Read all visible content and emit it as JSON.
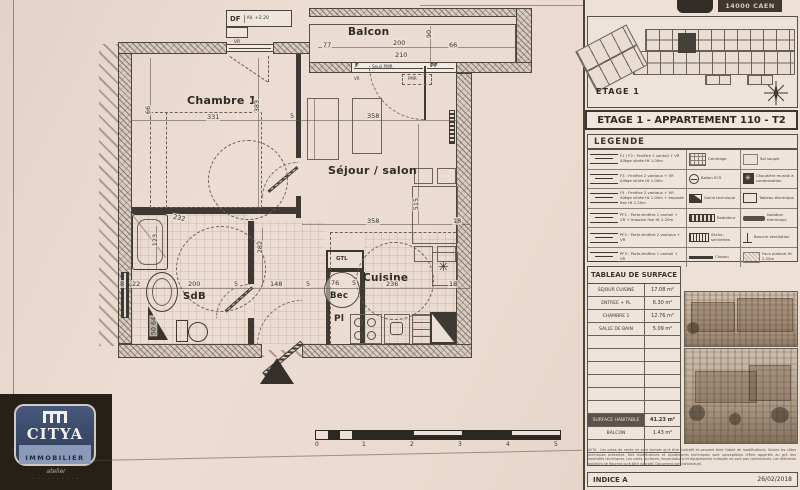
{
  "plan": {
    "rooms": {
      "chambre": "Chambre 1",
      "sejour": "Séjour / salon",
      "sdb": "SdB",
      "cuisine": "Cuisine",
      "balcon": "Balcon",
      "pl": "Pl",
      "bec": "Bec",
      "gtl": "GTL"
    },
    "annotations": {
      "df": "DF",
      "df_note": "All. +2.20",
      "vr": "VR",
      "f": "F",
      "seuil": "Seuil PMR",
      "pf": "PF",
      "vr2": "VR",
      "pmr": "PMR"
    },
    "dims": {
      "d77": "77",
      "d200": "200",
      "d210": "210",
      "d66b": "66",
      "d90": "90",
      "d331": "331",
      "d383": "383",
      "d66v": "66",
      "d5a": "5",
      "d358t": "358",
      "d358b": "358",
      "d515": "515",
      "d18a": "18",
      "d8": "8",
      "d22": "22",
      "d123": "123",
      "d200s": "200",
      "d5b": "5",
      "d148": "148",
      "d5c": "5",
      "d76": "76",
      "d5d": "5",
      "d236": "236",
      "d18b": "18",
      "d282": "282",
      "d232": "232",
      "d5064": "50 64"
    },
    "scalebar": {
      "t0": "0",
      "t1": "1",
      "t2": "2",
      "t3": "3",
      "t4": "4",
      "t5": "5"
    }
  },
  "logo": {
    "brand": "CITYA",
    "subbrand": "IMMOBILIER",
    "tagline": "atelier",
    "letters": "· · · · · · · · · ·"
  },
  "sidebar": {
    "header": {
      "city": "14000 CAEN"
    },
    "siteplan": {
      "floor": "ETAGE 1"
    },
    "title": "ETAGE 1 - APPARTEMENT 110 - T2",
    "legend": {
      "heading": "LEGENDE",
      "rows": [
        {
          "left": "F1 / F2 : Fenêtre 1 vantail + VR Allège vitrée Ht 1.00m",
          "mid": "Carrelage",
          "right": "Sol souple"
        },
        {
          "left": "F3 : Fenêtre 2 vantaux + VR Allège vitrée Ht 1.00m",
          "mid": "Ballon ECS",
          "right": "Chaudière murale à condensation"
        },
        {
          "left": "F4 : Fenêtre 2 vantaux + VR Allège vitrée Ht 1.00m + Imposte fixe Ht 2.20m",
          "mid": "Gaine technique",
          "right": "Tableau électrique"
        },
        {
          "left": "PF1 : Porte-fenêtre 1 vantail + VR + Imposte fixe Ht 2.20m",
          "mid": "Radiateur",
          "right": "Isolation thermique"
        },
        {
          "left": "PF2 : Porte-fenêtre 2 vantaux + VR",
          "mid": "Sèche-serviettes",
          "right": "Bouche ventilation"
        },
        {
          "left": "PF3 : Porte-fenêtre 1 vantail + VR",
          "mid": "Cloison",
          "right": "Faux plafond Ht 2.20m"
        }
      ]
    },
    "surface_table": {
      "heading": "TABLEAU DE SURFACE",
      "rows": [
        {
          "label": "SEJOUR CUISINE",
          "value": "17.08 m²"
        },
        {
          "label": "ENTREE + PL",
          "value": "6.30 m²"
        },
        {
          "label": "CHAMBRE 1",
          "value": "12.76 m²"
        },
        {
          "label": "SALLE DE BAIN",
          "value": "5.09 m²"
        }
      ],
      "total": {
        "label": "SURFACE HABITABLE",
        "value": "41.23 m²"
      },
      "balcon": {
        "label": "BALCON",
        "value": "1.43 m²"
      }
    },
    "nota": "NOTA : Les plans de vente ne sont donnés qu'à titre indicatif et peuvent faire l'objet de modifications. Seules les côtes techniques prévalent. Des modifications et ajustements techniques sont susceptibles d'être apportés au gré des impératifs techniques. Les cotes, surfaces, implantations et équipements indiqués ne sont pas contractuels. Les éléments mobiliers ne figurent qu'à titre indicatif. Document non contractuel.",
    "footer": {
      "indice": "INDICE A",
      "date": "26/02/2018"
    }
  }
}
